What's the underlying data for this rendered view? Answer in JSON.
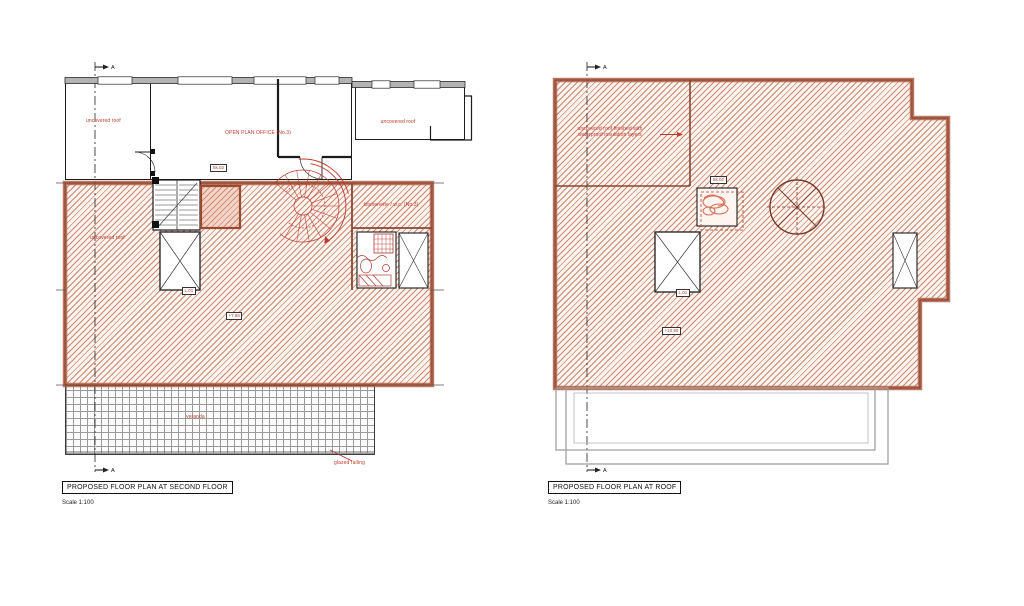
{
  "drawing": {
    "section_marker": "A",
    "left": {
      "title": "PROPOSED FLOOR PLAN AT SECOND FLOOR",
      "scale": "Scale 1:100",
      "labels": {
        "room_left": "uncovered roof",
        "room_center": "OPEN PLAN OFFICE (No.3)",
        "room_right": "uncovered roof",
        "hatch_area": "uncovered roof",
        "kitchen": "kitchenette / w.c. (No.3)",
        "stair_tag": "Sk.02",
        "lift_tag": "L.01",
        "level_tag": "+7.85",
        "terrace": "veranda",
        "railing_note": "glazed railing"
      }
    },
    "right": {
      "title": "PROPOSED FLOOR PLAN AT ROOF",
      "scale": "Scale 1:100",
      "labels": {
        "roof_note_line1": "uncovered roof finished with",
        "roof_note_line2": "waterproof insulation layers",
        "stair_tag": "Sk.02",
        "lift_tag": "L.01",
        "level_tag": "+10.90"
      }
    },
    "colors": {
      "hatch_line": "#c16548",
      "wall_band": "#7c3a26",
      "red_ink": "#c0392b",
      "line_black": "#1f1f1f",
      "gray_outline": "#9a9a9a",
      "window_band": "#b3b3b3"
    }
  }
}
